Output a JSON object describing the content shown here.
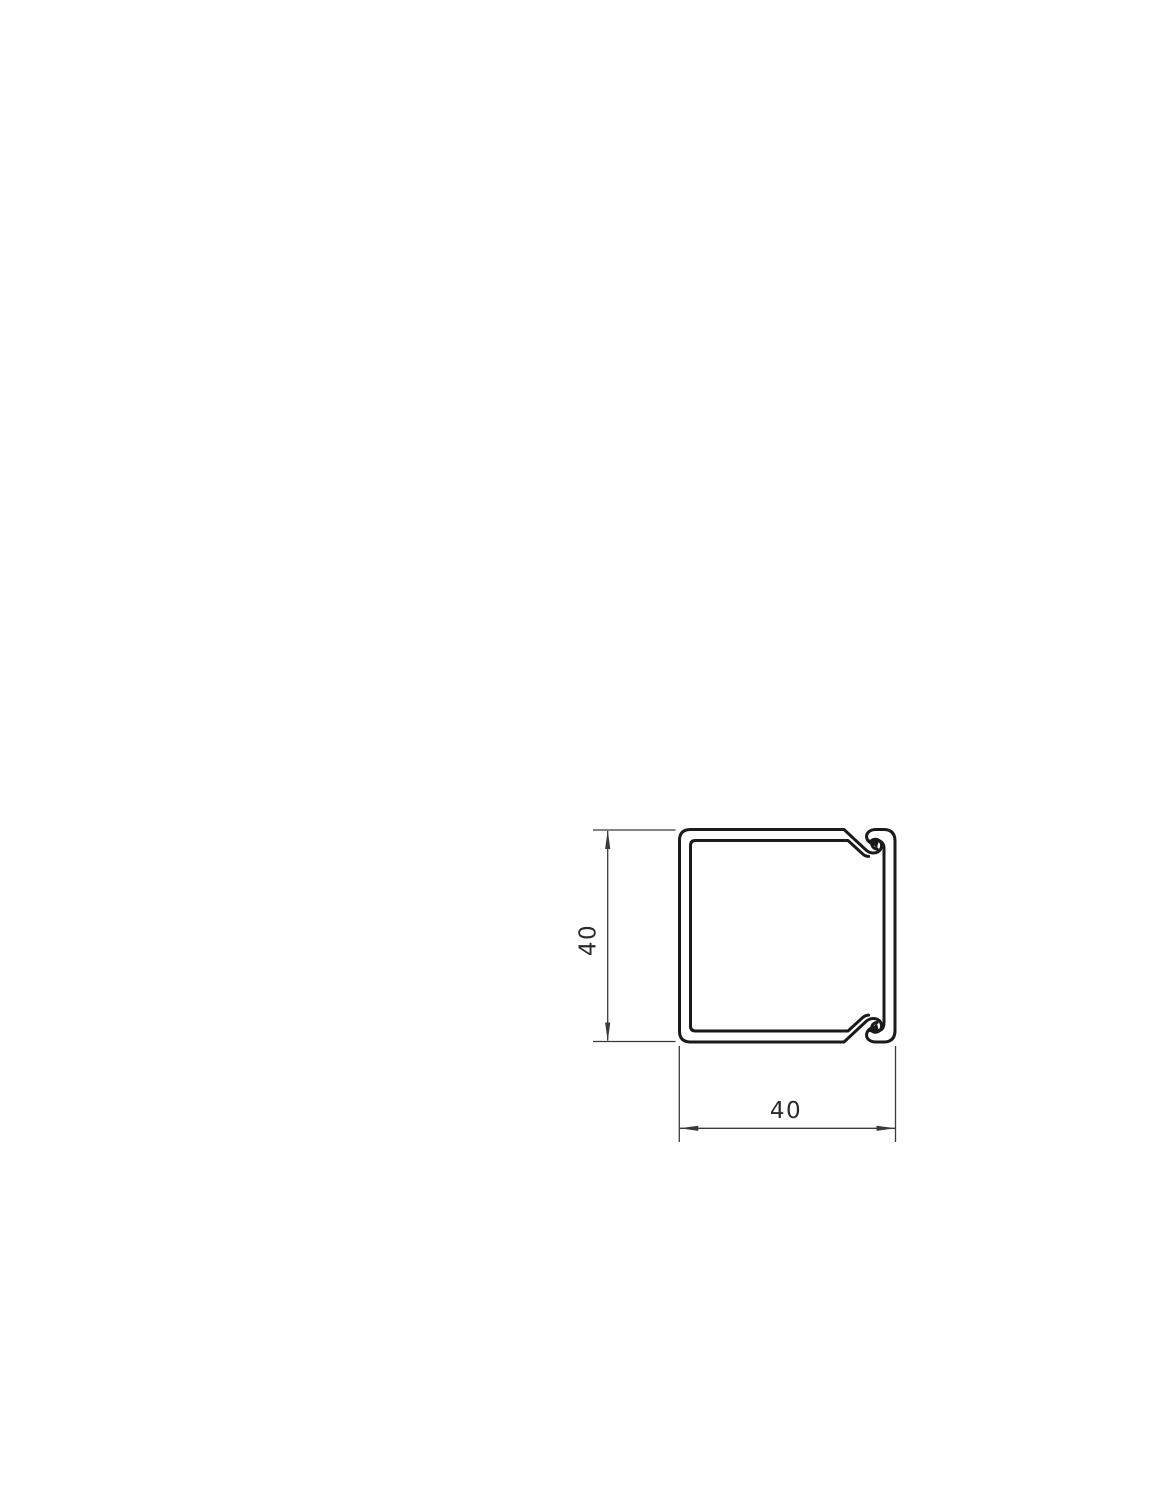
{
  "dimensions": {
    "height": {
      "label": "40"
    },
    "width": {
      "label": "40"
    }
  },
  "colors": {
    "profile_line": "#1a1a1a",
    "dimension_line": "#3a3a3a",
    "text": "#2a2a2a",
    "background": "#ffffff"
  }
}
